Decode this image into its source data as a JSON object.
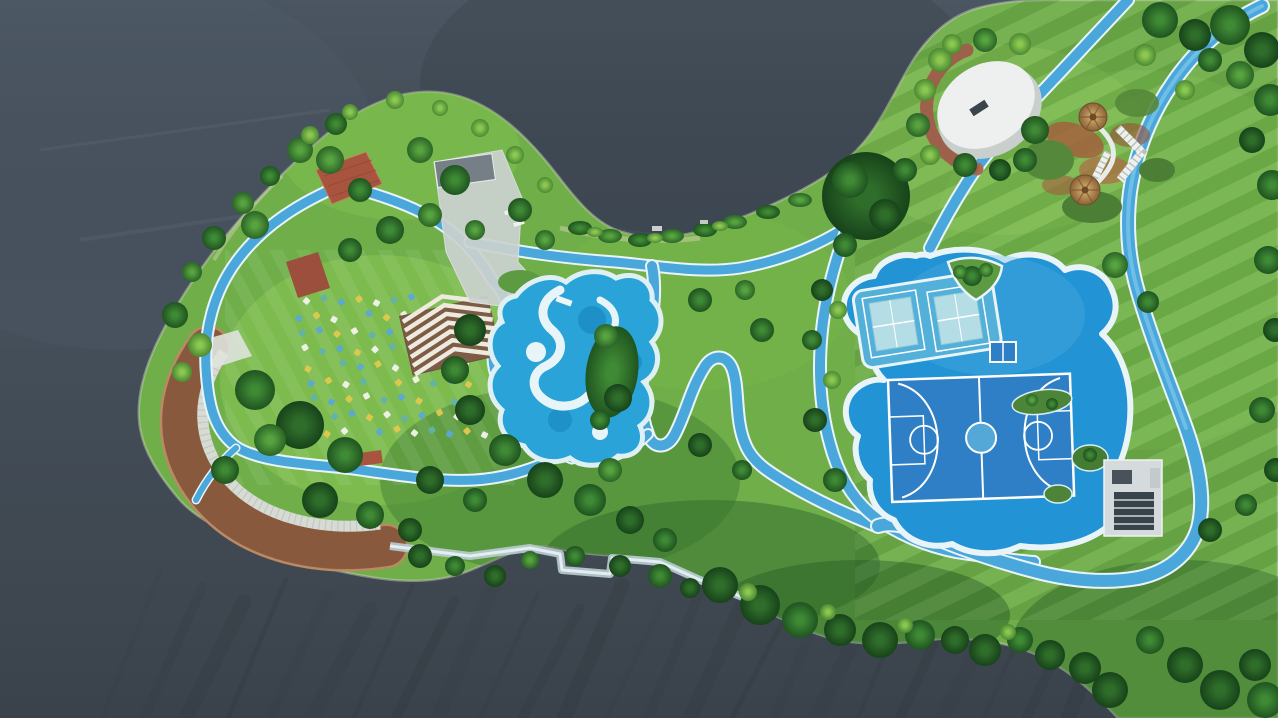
{
  "scene": {
    "name": "lakeside-park-aerial",
    "description": "Aerial drone photograph of a landscaped lakeside park peninsula featuring winding blue cycle paths, a lagoon swimming pool with lazy river, a blue sports zone with basketball and tennis courts, a white event stage oval, a thatch-umbrella playground, a curved wooden boardwalk and a lawn art installation of colorful pinwheels."
  },
  "palette": {
    "water": "#47525e",
    "water_deep": "#3a444f",
    "streak": "#272d30",
    "grass": "#6fae49",
    "grass_bright": "#8cc853",
    "grass_shadow": "#447f33",
    "path_blue": "#4aa7dc",
    "path_blue_light": "#8ed1ec",
    "path_edge": "#e9f4f7",
    "pool_blue": "#2aa3d8",
    "pool_white": "#e8f5f8",
    "sports_blue": "#2293d4",
    "court_blue": "#2e7fc6",
    "court_light": "#53b0d9",
    "court_line": "#ffffff",
    "boardwalk": "#996546",
    "boardwalk_dark": "#7c5136",
    "steps": "#d6dbd4",
    "deck_red": "#a8543f",
    "plaza": "#ccd2d0",
    "stage_white": "#edf0ef",
    "stage_ring": "#a96a52",
    "thatch": "#b68a54",
    "sand": "#d8d2b4"
  },
  "water": {
    "streaks": {
      "count": 24,
      "x_start": 160,
      "x_step": 42,
      "top_y": 572,
      "jitter": 38,
      "drift": -58
    }
  },
  "art_installation": {
    "origin_x": 292,
    "origin_y": 300,
    "rows": 9,
    "cols": 10,
    "dx": 17.5,
    "dy": 16.5,
    "row_shear": 4,
    "size": 6,
    "colors": [
      "#e2c84e",
      "#f1f3ec",
      "#62b2ac",
      "#5aa8d8"
    ]
  },
  "features": [
    {
      "name": "lake-water"
    },
    {
      "name": "peninsula-landmass"
    },
    {
      "name": "west-boardwalk"
    },
    {
      "name": "terrace-steps"
    },
    {
      "name": "pinwheel-art-field"
    },
    {
      "name": "striped-pergola"
    },
    {
      "name": "gray-plaza"
    },
    {
      "name": "red-wood-decks"
    },
    {
      "name": "lagoon-pool"
    },
    {
      "name": "zigzag-cycle-path"
    },
    {
      "name": "sports-court-area"
    },
    {
      "name": "basketball-court"
    },
    {
      "name": "tennis-courts"
    },
    {
      "name": "table-tennis-table"
    },
    {
      "name": "event-stage-oval"
    },
    {
      "name": "playground-umbrellas"
    },
    {
      "name": "big-tree"
    },
    {
      "name": "service-building"
    }
  ]
}
